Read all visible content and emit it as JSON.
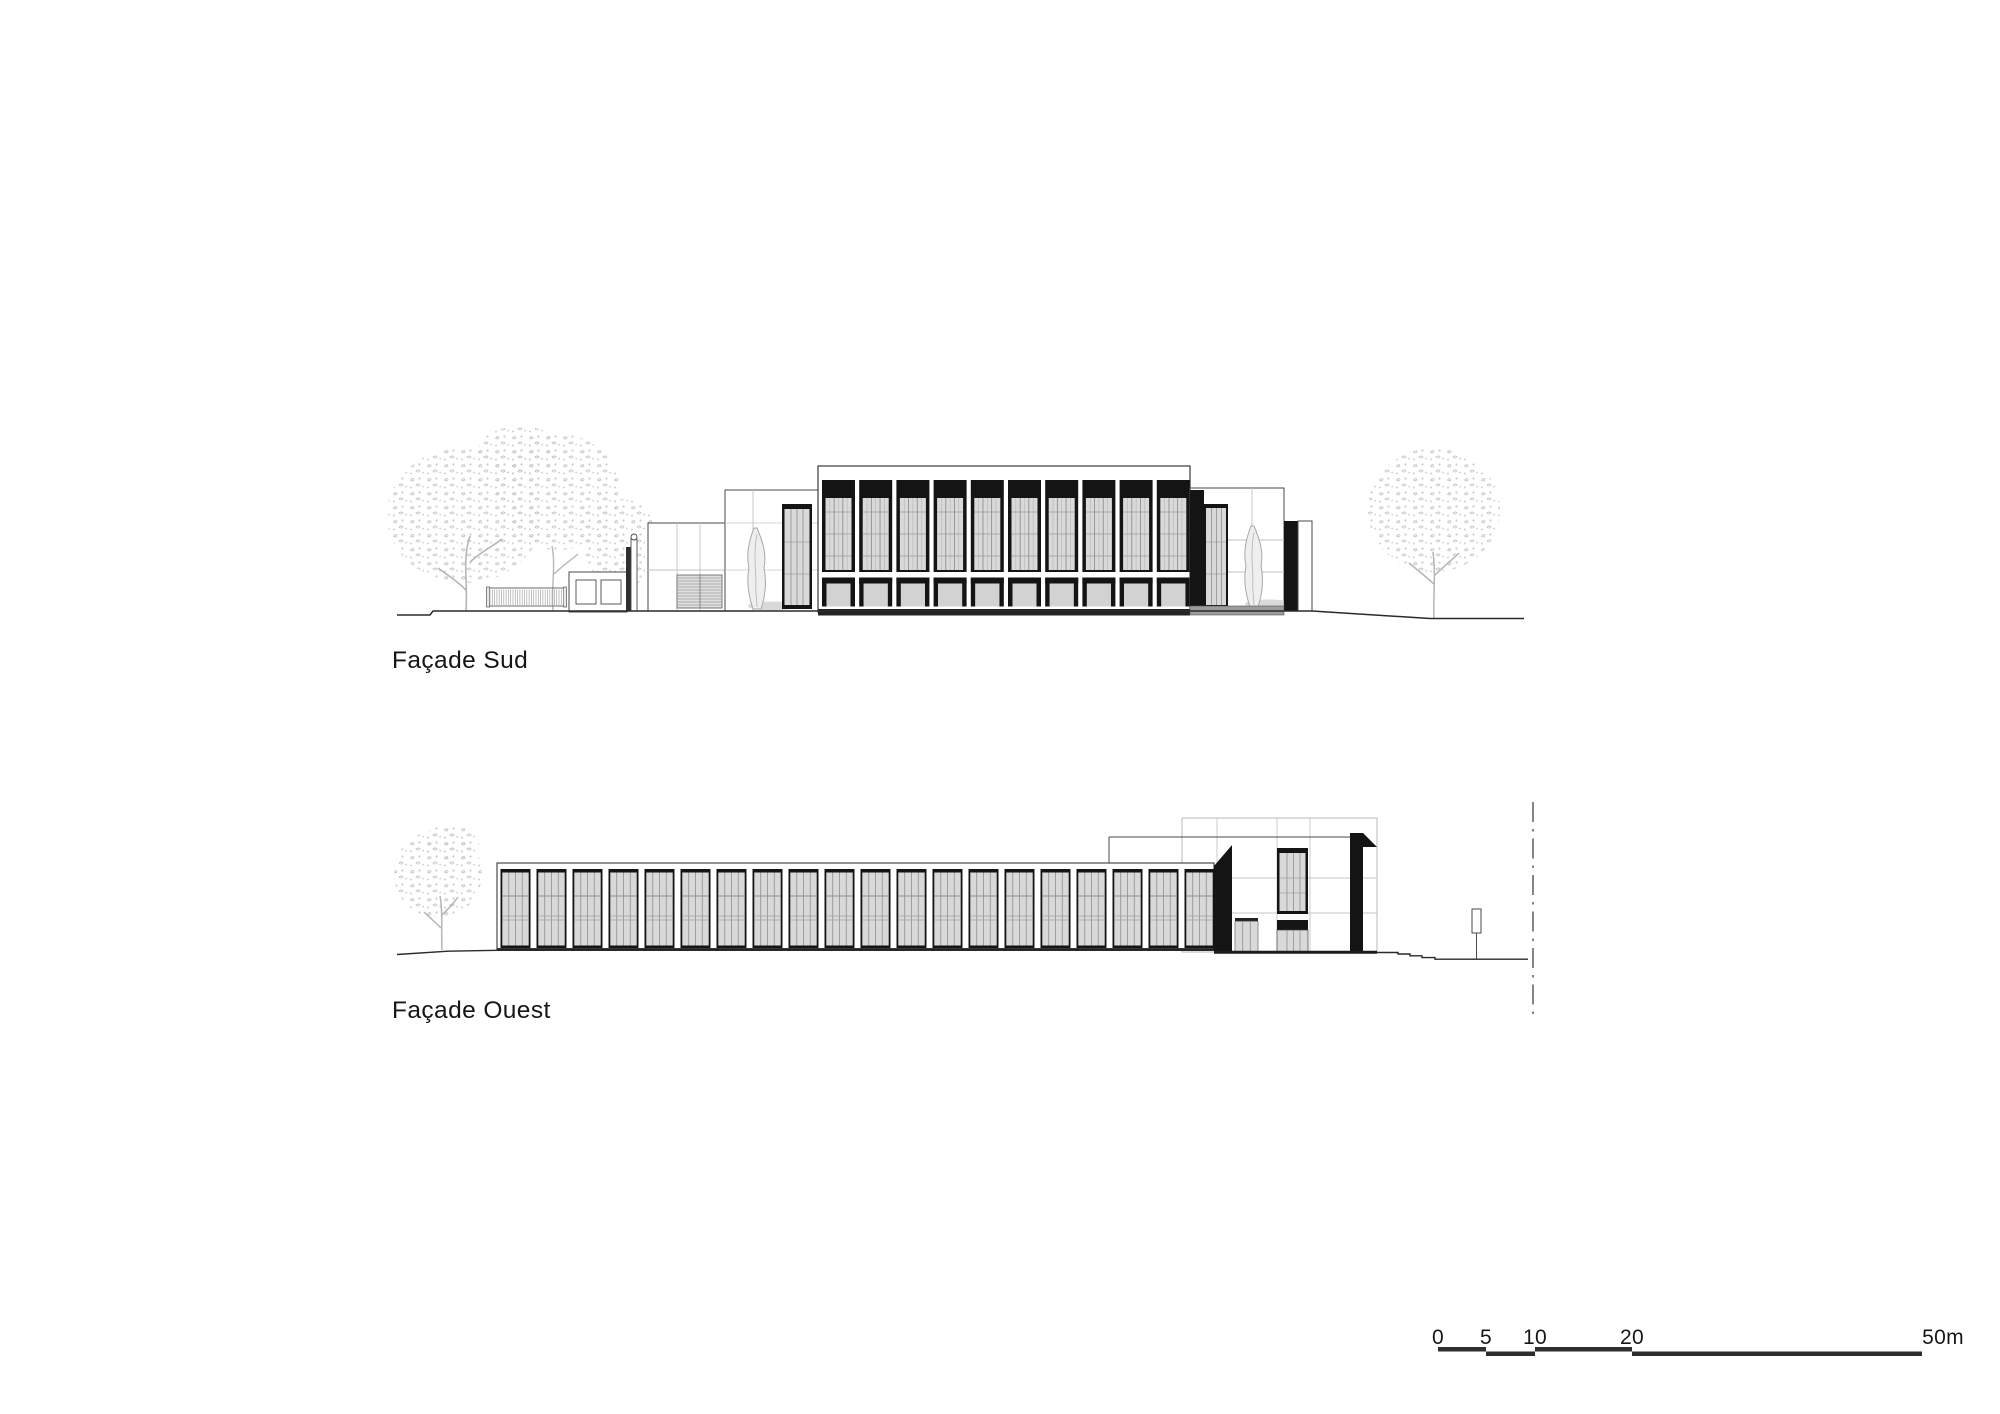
{
  "sheet": {
    "type": "architectural elevation drawing",
    "background": "#ffffff"
  },
  "labels": {
    "facade_sud": "Façade Sud",
    "facade_ouest": "Façade Ouest"
  },
  "scale_bar": {
    "ticks": [
      "0",
      "5",
      "10",
      "20",
      "50m"
    ],
    "bar_color": "#2e2e2e"
  },
  "colors": {
    "frame": "#141414",
    "glass": "#d9d9d9",
    "glass_lower": "#d2d2d2",
    "mullion": "#8f8f8f",
    "mullion_light": "#b5b5b5",
    "line_dark": "#2a2a2a",
    "line_mid": "#4a4a4a",
    "line_light": "#c2c2c2",
    "foliage": "#c6c6c6",
    "trunk": "#b5b5b5",
    "base_gray": "#9c9c9c",
    "label": "#161616"
  },
  "drawing": {
    "facade_sud": {
      "main_block_bays": 10,
      "trees": 3,
      "has_fence": true,
      "has_kiosk": true,
      "cypresses": 2
    },
    "facade_ouest": {
      "curtain_bays": 20,
      "trees": 1,
      "tall_block_doors": 2,
      "tall_block_windows": 1
    }
  }
}
